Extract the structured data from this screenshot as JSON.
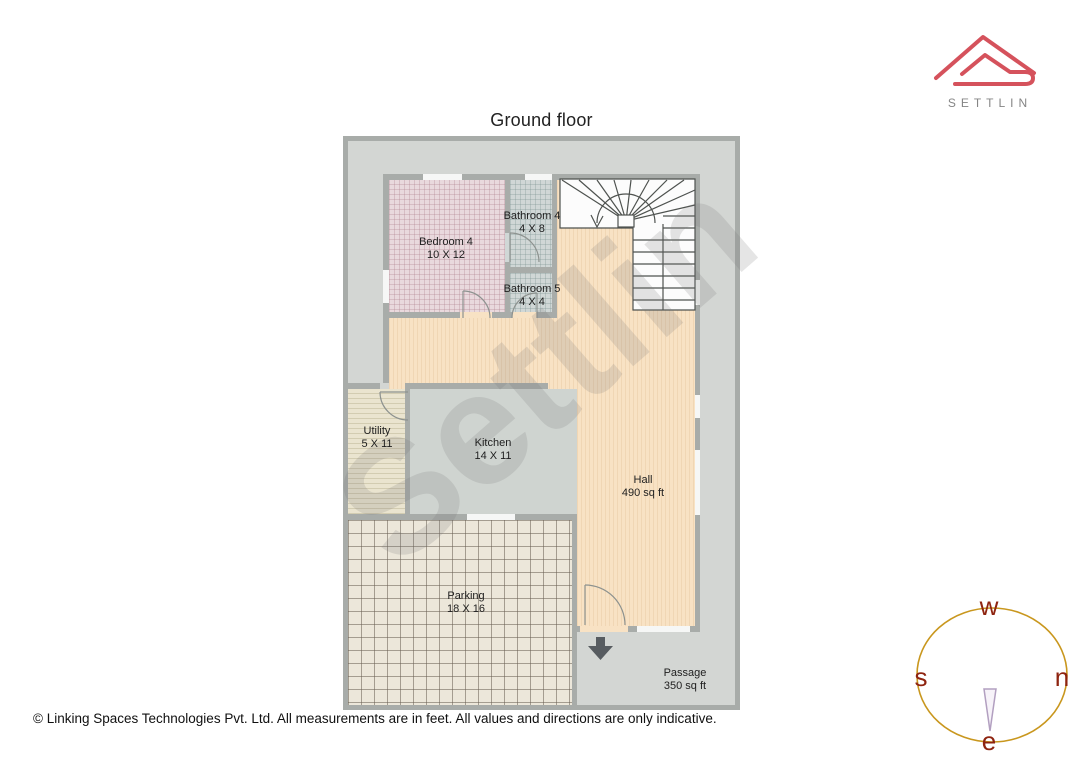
{
  "title": "Ground floor",
  "watermark_text": "Settlin",
  "brand": {
    "name": "SETTLIN",
    "logo_color": "#d5525c",
    "text_color": "#858585"
  },
  "rooms": [
    {
      "id": "bedroom4",
      "name": "Bedroom 4",
      "dimensions": "10 X 12"
    },
    {
      "id": "bathroom4",
      "name": "Bathroom 4",
      "dimensions": "4 X 8"
    },
    {
      "id": "bathroom5",
      "name": "Bathroom 5",
      "dimensions": "4 X 4"
    },
    {
      "id": "utility",
      "name": "Utility",
      "dimensions": "5 X 11"
    },
    {
      "id": "kitchen",
      "name": "Kitchen",
      "dimensions": "14 X 11"
    },
    {
      "id": "hall",
      "name": "Hall",
      "dimensions": "490 sq ft"
    },
    {
      "id": "parking",
      "name": "Parking",
      "dimensions": "18 X 16"
    },
    {
      "id": "passage",
      "name": "Passage",
      "dimensions": "350 sq ft"
    }
  ],
  "compass": {
    "top": "w",
    "right": "n",
    "left": "s",
    "bottom": "e",
    "circle_color": "#c9971e",
    "letter_color": "#8e2410"
  },
  "footer": {
    "copyright": "© Linking Spaces Technologies Pvt. Ltd. All measurements are in feet. All values and directions are only indicative."
  },
  "colors": {
    "plot_fill": "#d3d6d3",
    "wall": "#a8aca9",
    "bedroom_fill": "#e9d9dd",
    "bathroom_fill": "#d0d7d6",
    "hall_fill": "#f8e2c4",
    "kitchen_fill": "#cfd4d0",
    "utility_fill": "#eae4cf",
    "parking_fill": "#ece7da",
    "stairs_fill": "#fcfcfc"
  }
}
